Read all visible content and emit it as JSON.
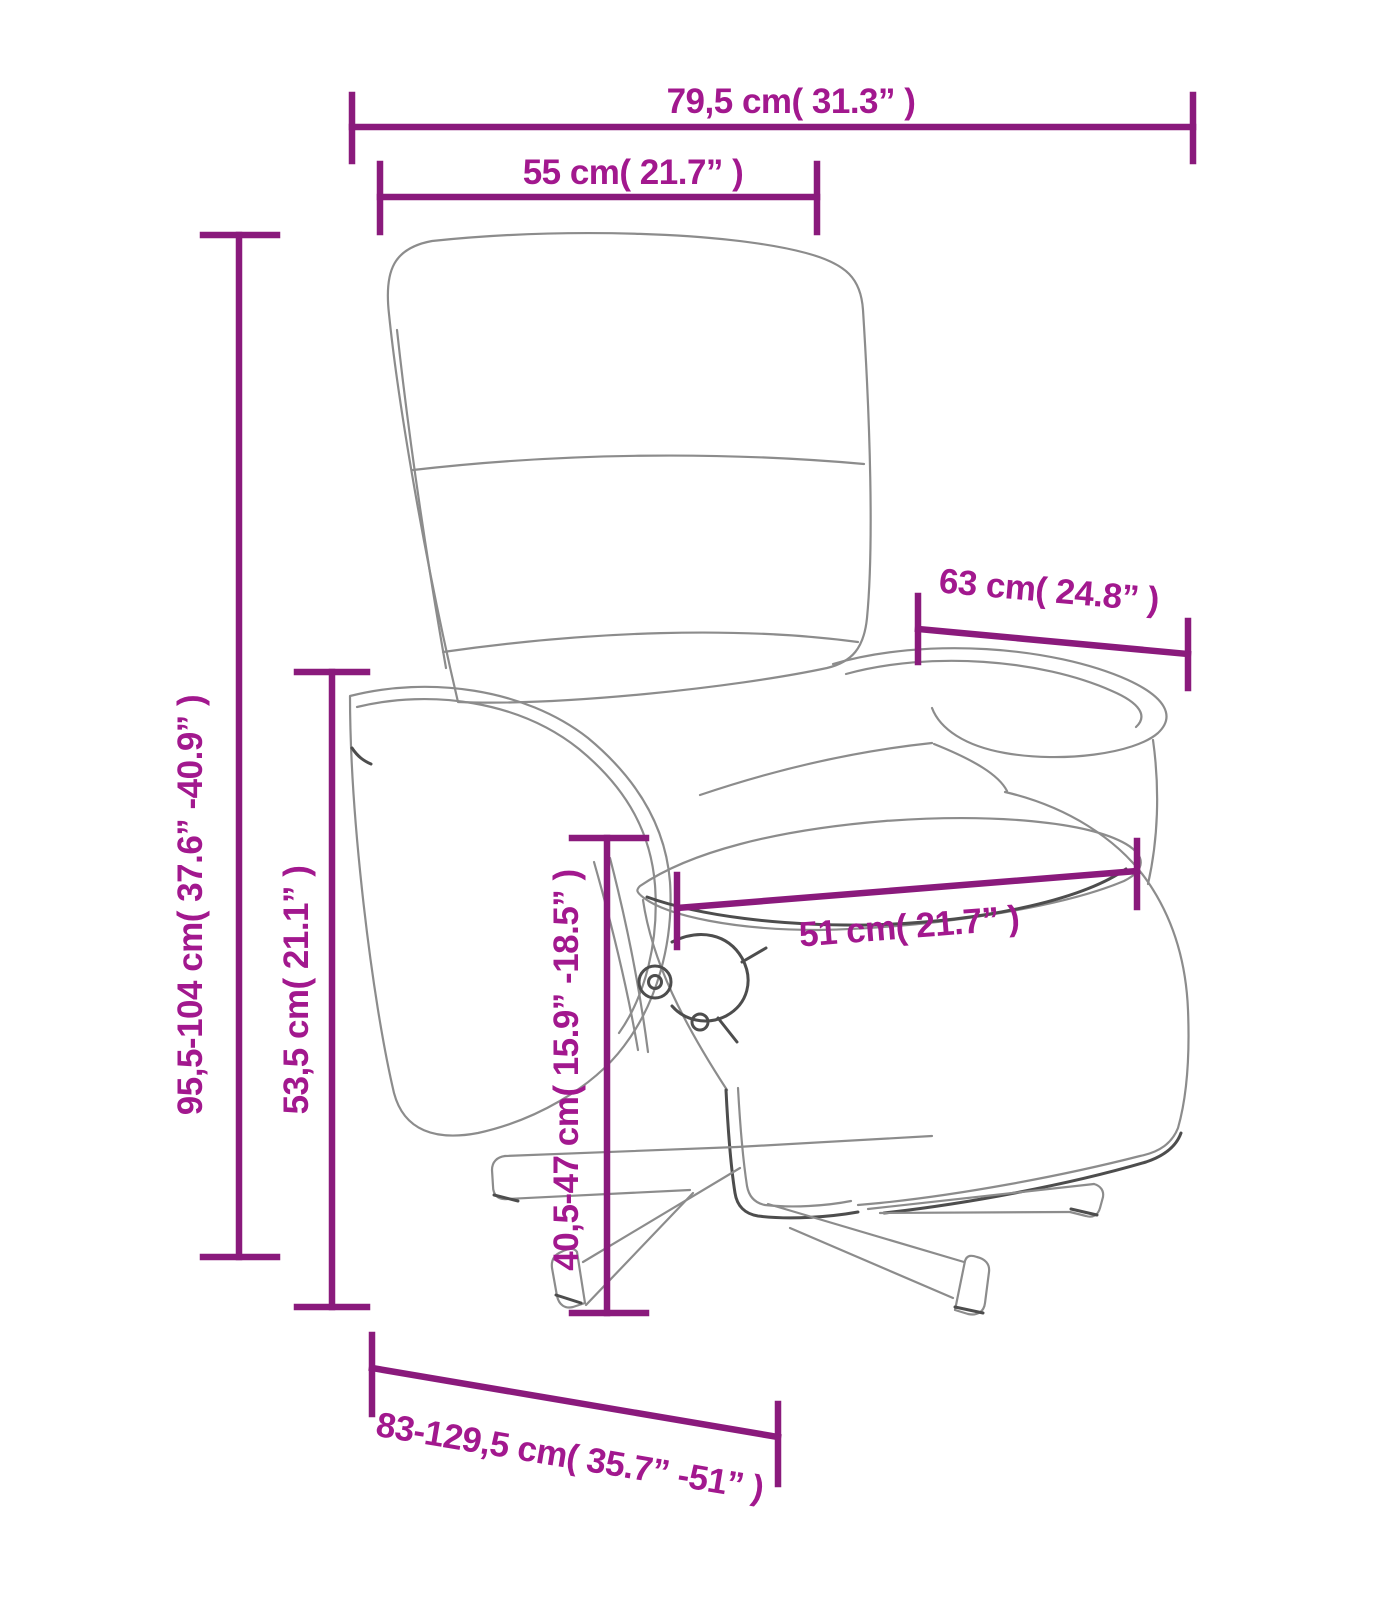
{
  "figure": {
    "type": "product-dimension-diagram",
    "subject": "Recliner armchair with footrest and swivel star base, line drawing with measurements"
  },
  "style": {
    "background": "#ffffff",
    "dimension_line_color": "#8a1a7c",
    "dimension_label_color": "#a2188e",
    "line_art_color": "#8c8c8c",
    "line_art_dark_color": "#4d4d4d"
  },
  "dimensions": {
    "overall_width": {
      "label": "79,5 cm( 31.3” )",
      "cm": "79,5",
      "in": "31.3",
      "orientation": "horizontal"
    },
    "backrest_width": {
      "label": "55 cm( 21.7” )",
      "cm": "55",
      "in": "21.7",
      "orientation": "horizontal"
    },
    "overall_height": {
      "label": "95,5-104 cm( 37.6”  -40.9” )",
      "cm": "95,5-104",
      "in": "37.6-40.9",
      "orientation": "vertical"
    },
    "armrest_height": {
      "label": "53,5 cm( 21.1” )",
      "cm": "53,5",
      "in": "21.1",
      "orientation": "vertical"
    },
    "armrest_depth": {
      "label": "63 cm( 24.8” )",
      "cm": "63",
      "in": "24.8",
      "orientation": "slanted"
    },
    "seat_width": {
      "label": "51 cm( 21.7” )",
      "cm": "51",
      "in": "21.7",
      "orientation": "slanted"
    },
    "seat_height": {
      "label": "40,5-47 cm( 15.9”  -18.5” )",
      "cm": "40,5-47",
      "in": "15.9-18.5",
      "orientation": "vertical"
    },
    "overall_depth": {
      "label": "83-129,5 cm( 35.7”  -51” )",
      "cm": "83-129,5",
      "in": "35.7-51",
      "orientation": "slanted"
    }
  }
}
